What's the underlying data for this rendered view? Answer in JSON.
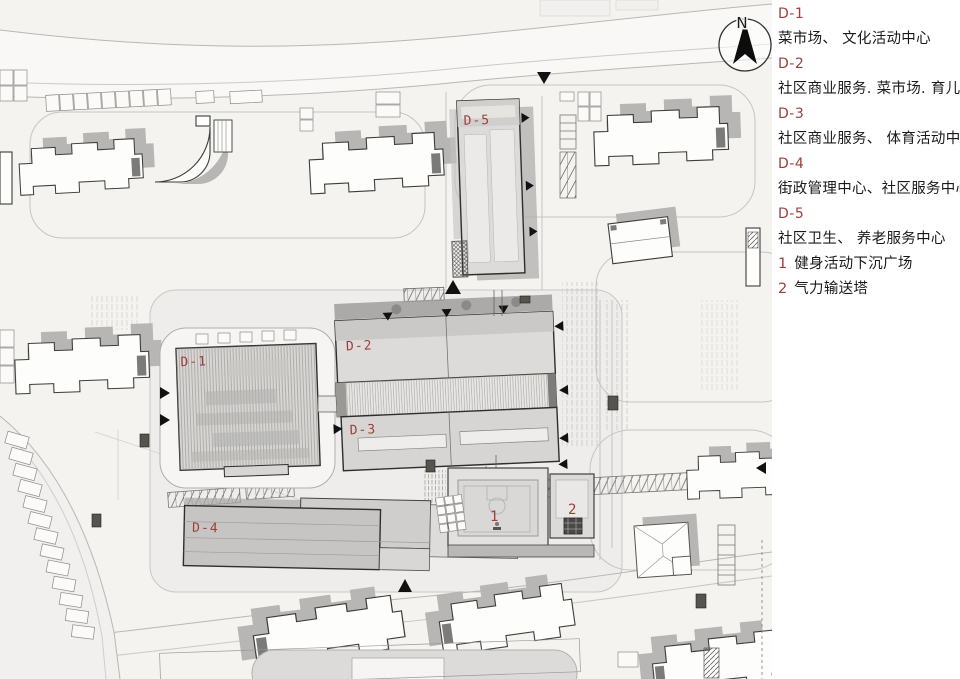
{
  "page": {
    "background": "#ffffff",
    "accent_red": "#9c3f39"
  },
  "compass": {
    "north_label": "N"
  },
  "plan": {
    "labels": {
      "d1": "D-1",
      "d2": "D-2",
      "d3": "D-3",
      "d4": "D-4",
      "d5": "D-5",
      "spot1": "1",
      "spot2": "2"
    },
    "label_color": "#9c3f39"
  },
  "legend": {
    "entries": [
      {
        "code": "D-1",
        "desc": "菜市场、 文化活动中心"
      },
      {
        "code": "D-2",
        "desc": "社区商业服务. 菜市场. 育儿园"
      },
      {
        "code": "D-3",
        "desc": "社区商业服务、 体育活动中心"
      },
      {
        "code": "D-4",
        "desc": "街政管理中心、社区服务中心"
      },
      {
        "code": "D-5",
        "desc": "社区卫生、 养老服务中心"
      }
    ],
    "numbered": [
      {
        "num": "1",
        "label": "健身活动下沉广场"
      },
      {
        "num": "2",
        "label": "气力输送塔"
      }
    ],
    "code_color": "#9c3f39",
    "text_color": "#1a1a1a"
  }
}
